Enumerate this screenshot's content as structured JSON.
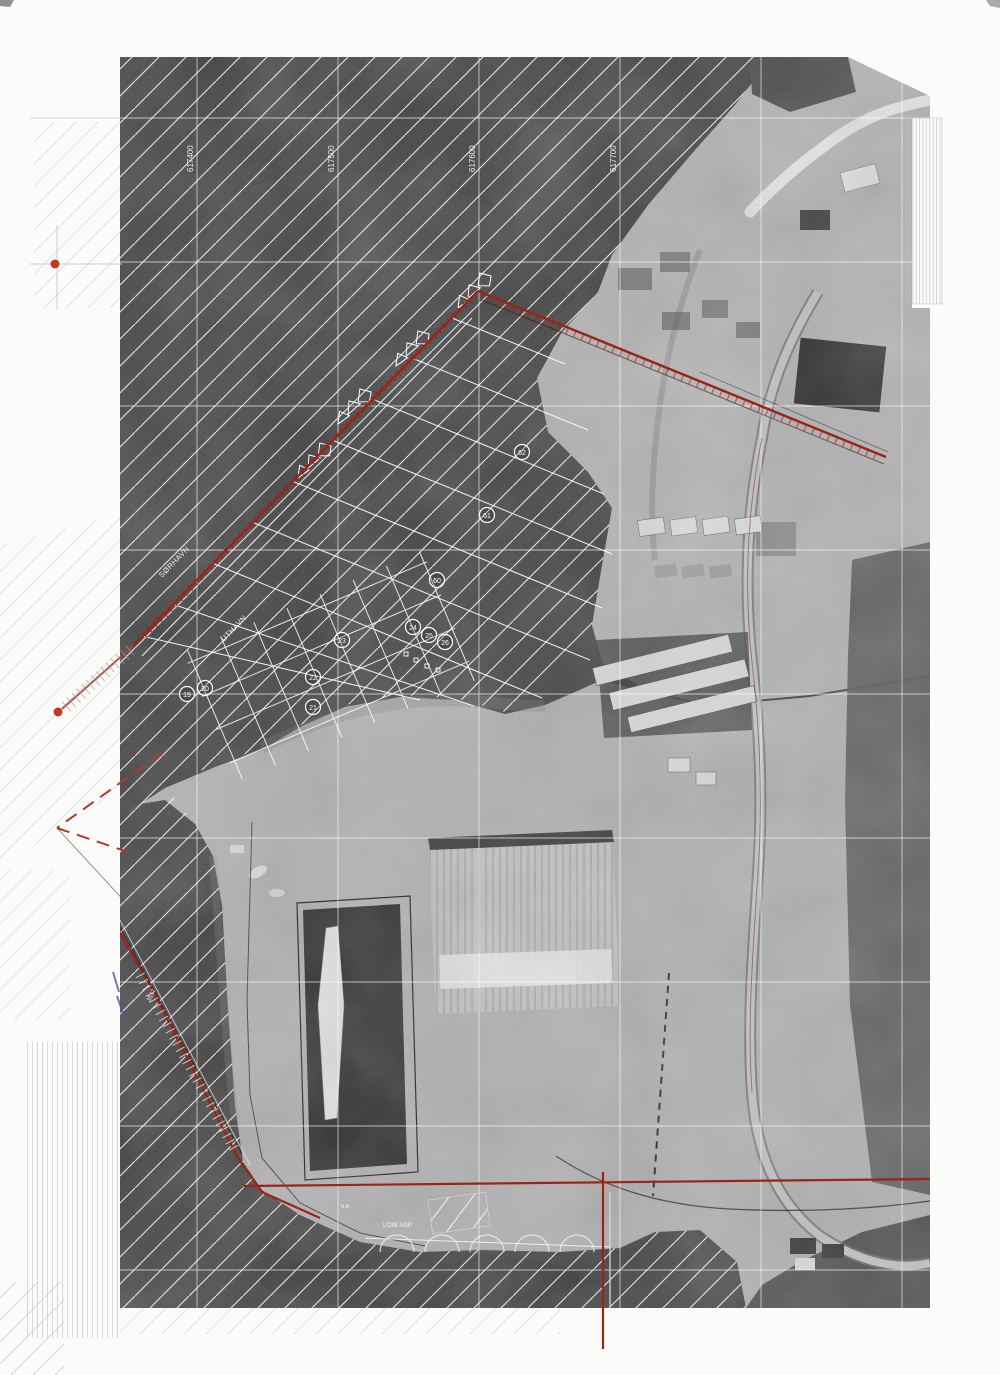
{
  "document": {
    "type": "scanned aerial survey map sheet"
  },
  "colors": {
    "paper": "#fbfbf9",
    "sea": "#3f3f3f",
    "land": "#b2b2b2",
    "vegetation": "#585858",
    "overlay_white": "#ffffff",
    "boundary_red": "#9c2318",
    "dashed_red": "#b5372b",
    "survey_dot_red": "#c0392b",
    "margin_grey": "#c8c8c8",
    "blue_mark": "#5555b0"
  },
  "grid": {
    "labels": [
      "617400",
      "617500",
      "617600",
      "617700"
    ]
  },
  "labels": {
    "shore_upper": "SØRHAVN",
    "shore_lower": "UTHAVN",
    "quay": "LOW ASP",
    "left_shore_small": "3517",
    "quay_small": "5,6"
  },
  "markers": {
    "values": [
      "62",
      "61",
      "60",
      "24",
      "25",
      "26",
      "23",
      "22",
      "21",
      "20",
      "19"
    ]
  }
}
